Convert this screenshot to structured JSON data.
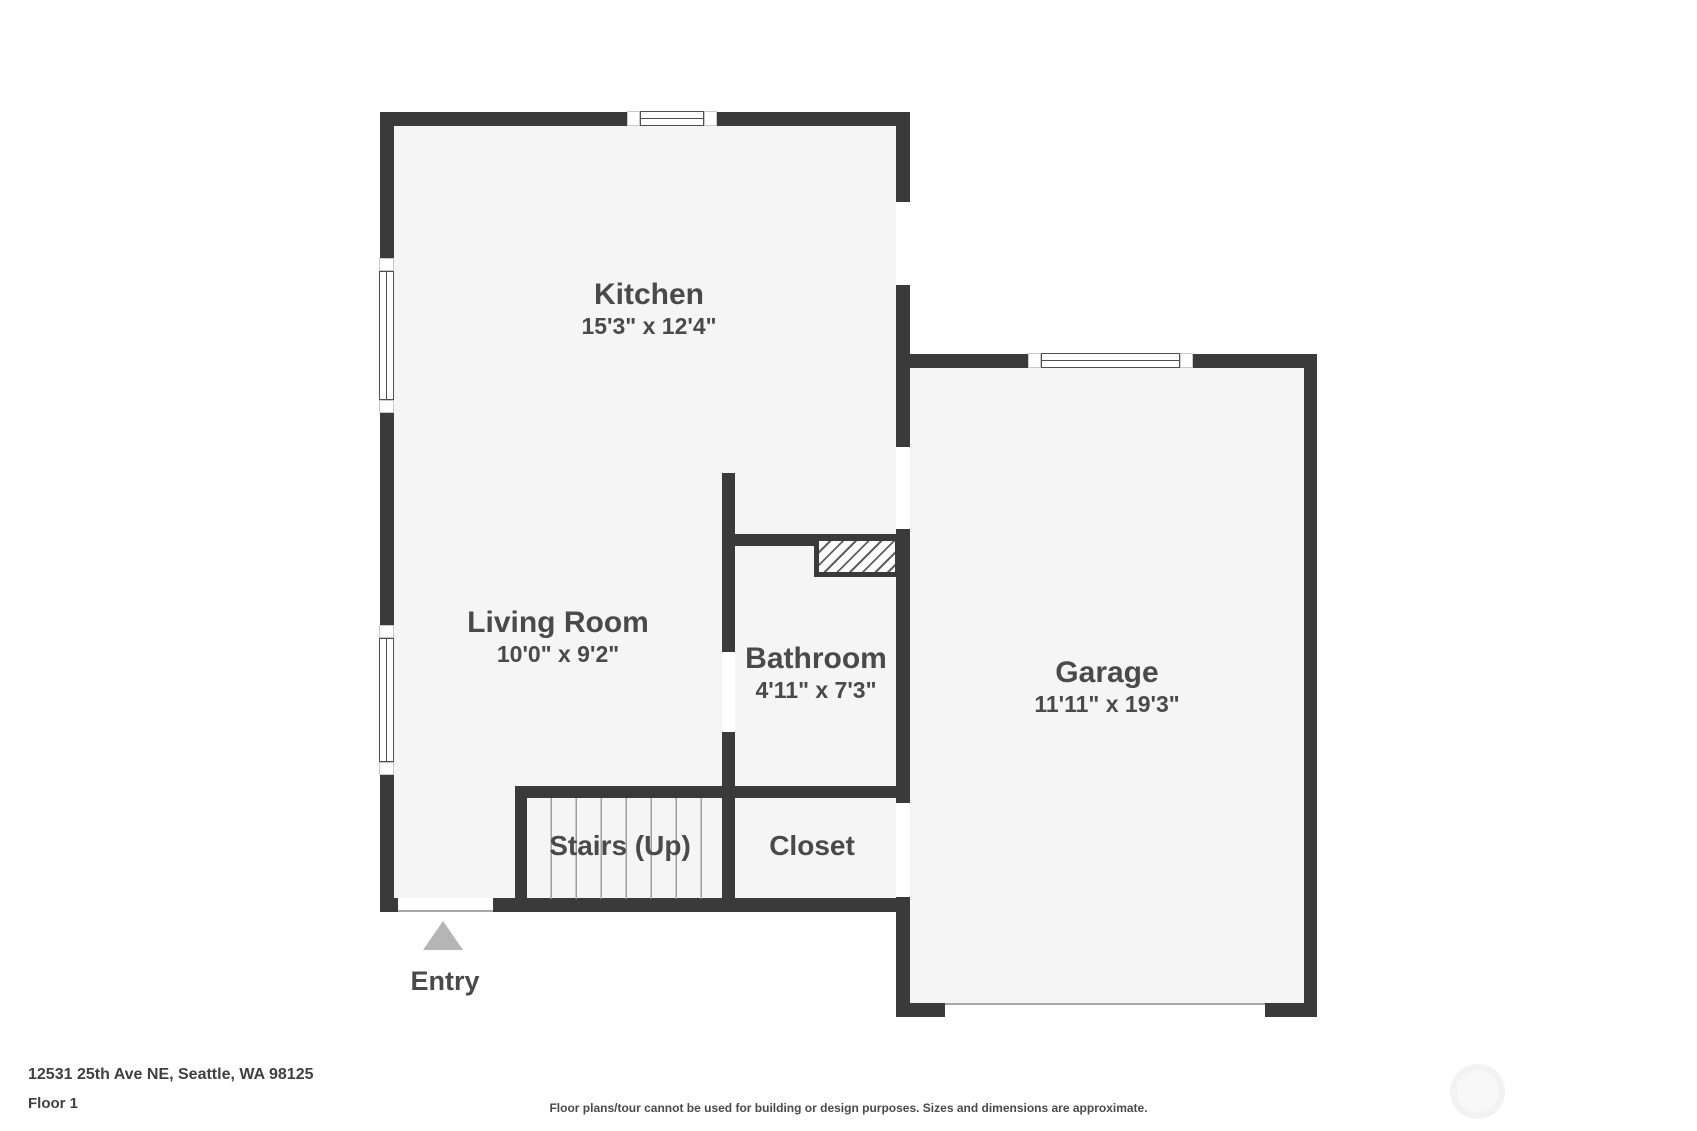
{
  "colors": {
    "page_bg": "#ffffff",
    "wall": "#3a3a3a",
    "floor": "#f5f5f5",
    "text": "#4a4a4a",
    "window_frame": "#4f4f4f",
    "tread_line": "#9e9e9e",
    "entry_arrow": "#b5b5b5",
    "thin_line": "#a8a8a8",
    "footer_text": "#404040",
    "watermark": "#f2f2f2"
  },
  "rooms": {
    "kitchen": {
      "name": "Kitchen",
      "dims": "15'3\" x 12'4\""
    },
    "living_room": {
      "name": "Living Room",
      "dims": "10'0\" x 9'2\""
    },
    "bathroom": {
      "name": "Bathroom",
      "dims": "4'11\" x 7'3\""
    },
    "garage": {
      "name": "Garage",
      "dims": "11'11\" x 19'3\""
    },
    "stairs": {
      "name": "Stairs (Up)"
    },
    "closet": {
      "name": "Closet"
    },
    "entry": {
      "name": "Entry"
    }
  },
  "footer": {
    "address": "12531 25th Ave NE, Seattle, WA 98125",
    "floor": "Floor 1",
    "disclaimer": "Floor plans/tour cannot be used for building or design purposes. Sizes and dimensions are approximate."
  }
}
